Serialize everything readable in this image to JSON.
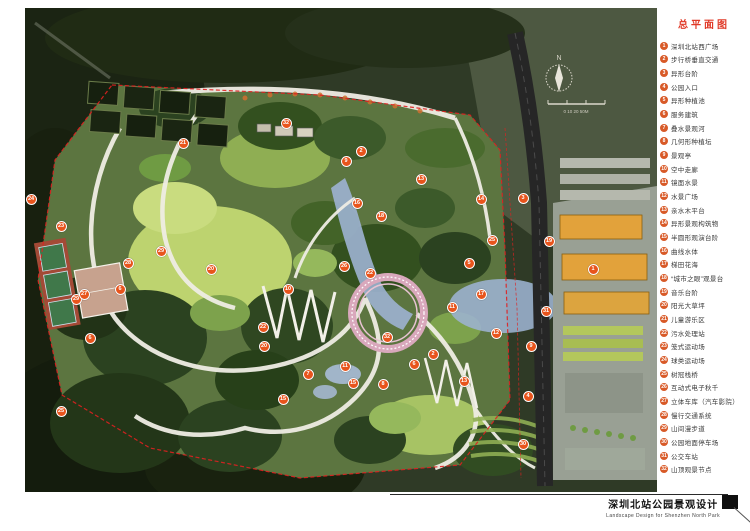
{
  "header": {
    "title": "总平面图"
  },
  "legend": {
    "items": [
      {
        "num": "1",
        "label": "深圳北站西广场"
      },
      {
        "num": "2",
        "label": "步行桥垂直交通"
      },
      {
        "num": "3",
        "label": "异形台阶"
      },
      {
        "num": "4",
        "label": "公园入口"
      },
      {
        "num": "5",
        "label": "异形种植池"
      },
      {
        "num": "6",
        "label": "服务建筑"
      },
      {
        "num": "7",
        "label": "叠水景观河"
      },
      {
        "num": "8",
        "label": "几何形种植坛"
      },
      {
        "num": "9",
        "label": "景观亭"
      },
      {
        "num": "10",
        "label": "空中走廊"
      },
      {
        "num": "11",
        "label": "镜面水景"
      },
      {
        "num": "12",
        "label": "水景广场"
      },
      {
        "num": "13",
        "label": "亲水木平台"
      },
      {
        "num": "14",
        "label": "异形景观构筑物"
      },
      {
        "num": "15",
        "label": "半圆形观演台阶"
      },
      {
        "num": "16",
        "label": "曲线水体"
      },
      {
        "num": "17",
        "label": "梯田花海"
      },
      {
        "num": "18",
        "label": "“城市之眼”观景台"
      },
      {
        "num": "19",
        "label": "音乐台阶"
      },
      {
        "num": "20",
        "label": "阳光大草坪"
      },
      {
        "num": "21",
        "label": "儿童游乐区"
      },
      {
        "num": "22",
        "label": "污水处理站"
      },
      {
        "num": "23",
        "label": "笼式运动场"
      },
      {
        "num": "24",
        "label": "球类运动场"
      },
      {
        "num": "25",
        "label": "树冠栈桥"
      },
      {
        "num": "26",
        "label": "互动式电子秋千"
      },
      {
        "num": "27",
        "label": "立体车库（汽车影院）"
      },
      {
        "num": "28",
        "label": "慢行交通系统"
      },
      {
        "num": "29",
        "label": "山间漫步道"
      },
      {
        "num": "30",
        "label": "公园地面停车场"
      },
      {
        "num": "31",
        "label": "公交车站"
      },
      {
        "num": "32",
        "label": "山顶观景节点"
      }
    ]
  },
  "map": {
    "compass_label": "N",
    "scale_label": "0 10 20  50M",
    "markers": [
      {
        "n": "21",
        "x": 157,
        "y": 134
      },
      {
        "n": "32",
        "x": 260,
        "y": 114
      },
      {
        "n": "2",
        "x": 335,
        "y": 142
      },
      {
        "n": "9",
        "x": 320,
        "y": 152
      },
      {
        "n": "13",
        "x": 395,
        "y": 170
      },
      {
        "n": "14",
        "x": 455,
        "y": 190
      },
      {
        "n": "3",
        "x": 497,
        "y": 189
      },
      {
        "n": "16",
        "x": 331,
        "y": 194
      },
      {
        "n": "18",
        "x": 355,
        "y": 207
      },
      {
        "n": "26",
        "x": 318,
        "y": 257
      },
      {
        "n": "22",
        "x": 344,
        "y": 264
      },
      {
        "n": "10",
        "x": 262,
        "y": 280
      },
      {
        "n": "22",
        "x": 237,
        "y": 318
      },
      {
        "n": "20",
        "x": 238,
        "y": 337
      },
      {
        "n": "20",
        "x": 185,
        "y": 260
      },
      {
        "n": "7",
        "x": 282,
        "y": 365
      },
      {
        "n": "11",
        "x": 319,
        "y": 357
      },
      {
        "n": "15",
        "x": 327,
        "y": 374
      },
      {
        "n": "8",
        "x": 357,
        "y": 375
      },
      {
        "n": "32",
        "x": 361,
        "y": 328
      },
      {
        "n": "6",
        "x": 388,
        "y": 355
      },
      {
        "n": "2",
        "x": 407,
        "y": 345
      },
      {
        "n": "15",
        "x": 257,
        "y": 390
      },
      {
        "n": "5",
        "x": 443,
        "y": 254
      },
      {
        "n": "17",
        "x": 455,
        "y": 285
      },
      {
        "n": "11",
        "x": 426,
        "y": 298
      },
      {
        "n": "25",
        "x": 466,
        "y": 231
      },
      {
        "n": "12",
        "x": 470,
        "y": 324
      },
      {
        "n": "13",
        "x": 438,
        "y": 372
      },
      {
        "n": "29",
        "x": 135,
        "y": 242
      },
      {
        "n": "28",
        "x": 102,
        "y": 254
      },
      {
        "n": "6",
        "x": 94,
        "y": 280
      },
      {
        "n": "29",
        "x": 50,
        "y": 290
      },
      {
        "n": "6",
        "x": 64,
        "y": 329
      },
      {
        "n": "24",
        "x": 5,
        "y": 190
      },
      {
        "n": "23",
        "x": 35,
        "y": 217
      },
      {
        "n": "27",
        "x": 58,
        "y": 285
      },
      {
        "n": "25",
        "x": 35,
        "y": 402
      },
      {
        "n": "1",
        "x": 567,
        "y": 260
      },
      {
        "n": "19",
        "x": 523,
        "y": 232
      },
      {
        "n": "31",
        "x": 520,
        "y": 302
      },
      {
        "n": "9",
        "x": 505,
        "y": 337
      },
      {
        "n": "4",
        "x": 502,
        "y": 387
      },
      {
        "n": "30",
        "x": 497,
        "y": 435
      }
    ]
  },
  "footer": {
    "title_cn": "深圳北站公园景观设计",
    "title_en": "Landscape Design for Shenzhen North Park"
  },
  "colors": {
    "accent": "#d85a28",
    "marker": "#e8541c",
    "title_red": "#e03a28",
    "boundary_red": "#e02020",
    "water_blue": "#9db3d2",
    "lawn_green": "#bdd36f",
    "ring_pink": "#d9a8bc"
  }
}
